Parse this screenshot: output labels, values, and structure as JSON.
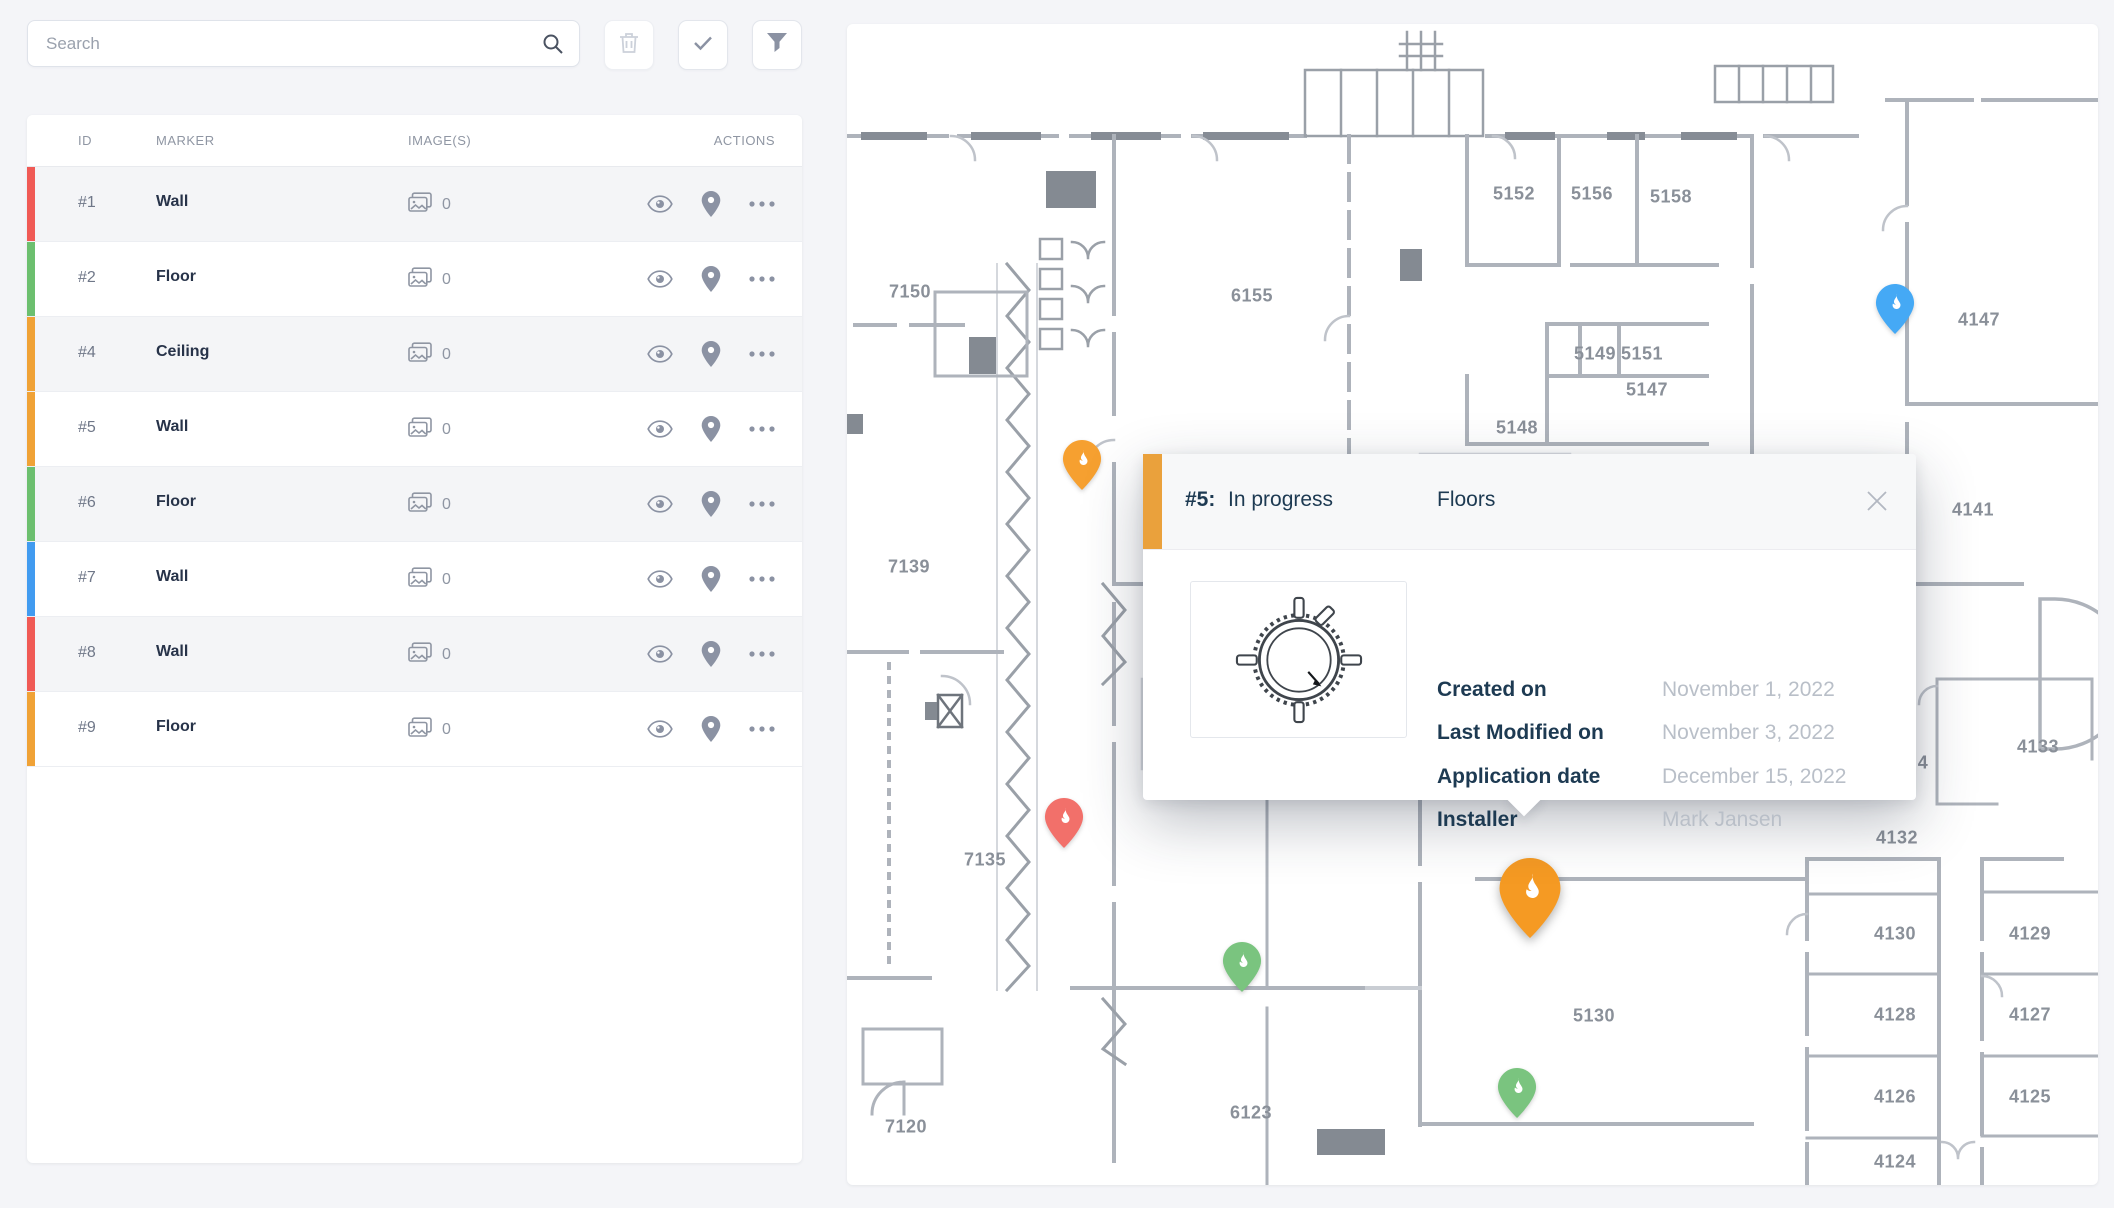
{
  "toolbar": {
    "search_placeholder": "Search",
    "buttons": [
      {
        "name": "delete",
        "icon": "trash-icon",
        "enabled": false
      },
      {
        "name": "confirm",
        "icon": "check-icon",
        "enabled": true
      },
      {
        "name": "filter",
        "icon": "funnel-icon",
        "enabled": true
      }
    ]
  },
  "table": {
    "headers": [
      "ID",
      "MARKER",
      "IMAGE(S)",
      "ACTIONS"
    ],
    "rows": [
      {
        "id": "#1",
        "marker": "Wall",
        "images": "0",
        "color": "#f05a55"
      },
      {
        "id": "#2",
        "marker": "Floor",
        "images": "0",
        "color": "#6cbf6f"
      },
      {
        "id": "#4",
        "marker": "Ceiling",
        "images": "0",
        "color": "#f0a236"
      },
      {
        "id": "#5",
        "marker": "Wall",
        "images": "0",
        "color": "#f0a236"
      },
      {
        "id": "#6",
        "marker": "Floor",
        "images": "0",
        "color": "#6cbf6f"
      },
      {
        "id": "#7",
        "marker": "Wall",
        "images": "0",
        "color": "#419bf0"
      },
      {
        "id": "#8",
        "marker": "Wall",
        "images": "0",
        "color": "#f05a55"
      },
      {
        "id": "#9",
        "marker": "Floor",
        "images": "0",
        "color": "#f0a236"
      }
    ]
  },
  "popup": {
    "id_label": "#5:",
    "status": "In progress",
    "category": "Floors",
    "accent_color": "#eaa13c",
    "fields": [
      {
        "label": "Created on",
        "value": "November 1, 2022"
      },
      {
        "label": "Last Modified on",
        "value": "November 3, 2022"
      },
      {
        "label": "Application date",
        "value": "December 15, 2022"
      },
      {
        "label": "Installer",
        "value": "Mark Jansen"
      }
    ]
  },
  "map": {
    "room_labels": [
      {
        "text": "7150",
        "x": 63,
        "y": 268
      },
      {
        "text": "6155",
        "x": 405,
        "y": 272
      },
      {
        "text": "5152",
        "x": 667,
        "y": 170
      },
      {
        "text": "5156",
        "x": 745,
        "y": 170
      },
      {
        "text": "5158",
        "x": 824,
        "y": 173
      },
      {
        "text": "5149",
        "x": 748,
        "y": 330
      },
      {
        "text": "5151",
        "x": 795,
        "y": 330
      },
      {
        "text": "5147",
        "x": 800,
        "y": 366
      },
      {
        "text": "5148",
        "x": 670,
        "y": 404
      },
      {
        "text": "4147",
        "x": 1132,
        "y": 296
      },
      {
        "text": "4141",
        "x": 1126,
        "y": 486
      },
      {
        "text": "7139",
        "x": 62,
        "y": 543
      },
      {
        "text": "4",
        "x": 1076,
        "y": 739
      },
      {
        "text": "4133",
        "x": 1191,
        "y": 723
      },
      {
        "text": "7135",
        "x": 138,
        "y": 836
      },
      {
        "text": "4132",
        "x": 1050,
        "y": 814
      },
      {
        "text": "4130",
        "x": 1048,
        "y": 910
      },
      {
        "text": "4129",
        "x": 1183,
        "y": 910
      },
      {
        "text": "4128",
        "x": 1048,
        "y": 991
      },
      {
        "text": "4127",
        "x": 1183,
        "y": 991
      },
      {
        "text": "4126",
        "x": 1048,
        "y": 1073
      },
      {
        "text": "4125",
        "x": 1183,
        "y": 1073
      },
      {
        "text": "5130",
        "x": 747,
        "y": 992
      },
      {
        "text": "6123",
        "x": 404,
        "y": 1089
      },
      {
        "text": "7120",
        "x": 59,
        "y": 1103
      },
      {
        "text": "4124",
        "x": 1048,
        "y": 1138
      }
    ],
    "pins": [
      {
        "name": "pin-blue",
        "color": "#45a9f5",
        "x": 1048,
        "y": 310,
        "size": "small",
        "selected": false
      },
      {
        "name": "pin-orange",
        "color": "#f6a030",
        "x": 235,
        "y": 466,
        "size": "small",
        "selected": false
      },
      {
        "name": "pin-red",
        "color": "#f2706a",
        "x": 217,
        "y": 824,
        "size": "small",
        "selected": false
      },
      {
        "name": "pin-green",
        "color": "#7ac47f",
        "x": 395,
        "y": 968,
        "size": "small",
        "selected": false
      },
      {
        "name": "pin-orange-selected",
        "color": "#f59a23",
        "x": 683,
        "y": 914,
        "size": "big",
        "selected": true
      },
      {
        "name": "pin-green-2",
        "color": "#7ac47f",
        "x": 670,
        "y": 1094,
        "size": "small",
        "selected": false
      }
    ]
  }
}
